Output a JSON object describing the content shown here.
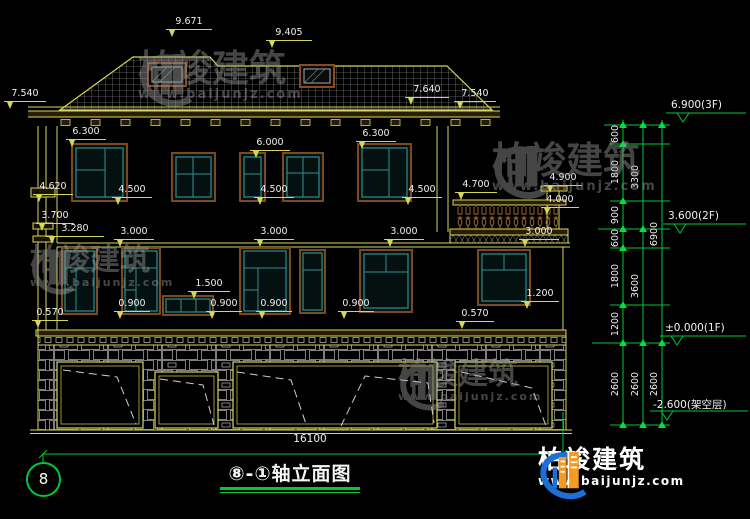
{
  "dims": {
    "roof": [
      "9.671",
      "9.405",
      "7.540",
      "7.640",
      "7.540"
    ],
    "f3": [
      "6.300",
      "6.000",
      "6.300",
      "4.620",
      "4.500",
      "4.500",
      "4.500",
      "3.700",
      "3.280",
      "4.700",
      "4.900",
      "4.000"
    ],
    "f2": [
      "3.000",
      "3.000",
      "3.000",
      "3.000",
      "0.570",
      "1.500",
      "0.900",
      "0.900",
      "0.900",
      "0.900",
      "1.200",
      "0.570"
    ],
    "total_width": "16100"
  },
  "chain": {
    "col1": [
      "600",
      "1800",
      "900",
      "600",
      "1800",
      "1200",
      "2600"
    ],
    "col2": [
      "3300",
      "3600",
      "2600"
    ],
    "col3": [
      "6900",
      "2600"
    ]
  },
  "elev": [
    "6.900(3F)",
    "3.600(2F)",
    "±0.000(1F)",
    "-2.600(架空层)"
  ],
  "footer": {
    "axis_bubble": "8",
    "title": "⑧-①轴立面图"
  },
  "branding": {
    "company": "柏竣建筑",
    "website": "www.baijunjz.com"
  },
  "watermark": {
    "company": "柏竣建筑",
    "website": "www.baijunjz.com"
  }
}
